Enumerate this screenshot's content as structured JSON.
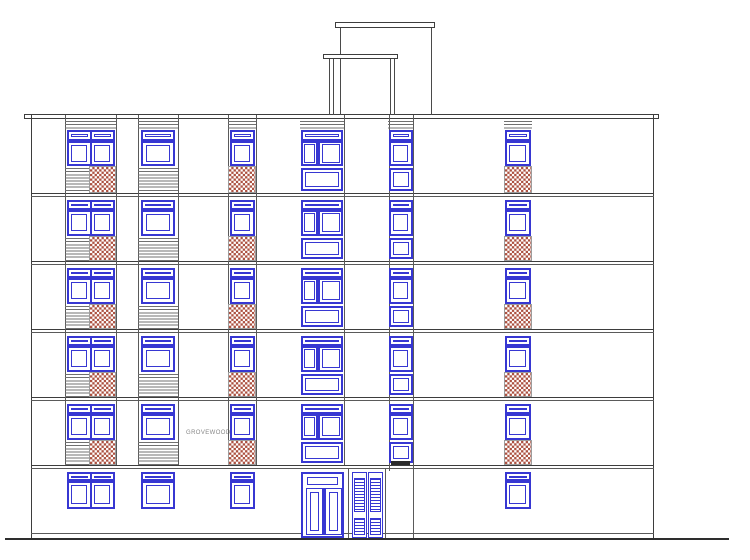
{
  "label": {
    "text": "GROVEWOOD",
    "x": 186,
    "y": 430
  },
  "canvas": {
    "width": 750,
    "height": 560
  },
  "colors": {
    "background": "#ffffff",
    "window_blue": "#3737d2",
    "brick_red": "#ac5140",
    "outline_dark": "#3d3d3d",
    "line_gray": "#5a5a5a",
    "stripe_gray": "#707070",
    "brick_border": "#9d9d9d",
    "vent_dark": "#2b2b2b",
    "ground_dark": "#2e2e2e"
  },
  "building": {
    "left": 31,
    "right": 654,
    "top": 115,
    "bottom": 537.5
  },
  "roof_band": {
    "x1": 24,
    "x2": 659,
    "y_top": 114,
    "y_bottom": 117.5
  },
  "floor_line_ys": [
    193,
    261,
    329,
    397,
    465
  ],
  "plinth_line": {
    "y": 532.5,
    "x1": 31,
    "x2": 654
  },
  "ground_line": {
    "y": 537.5,
    "x1": 5,
    "x2": 729,
    "thickness": 2.5
  },
  "penthouse": {
    "back": {
      "cap_x": 334.5,
      "cap_y": 22,
      "cap_w": 100,
      "cap_h": 5.5,
      "verticals": [
        339.5,
        430.5
      ],
      "v_y1": 27.5,
      "v_y2": 115
    },
    "front": {
      "cap_x": 322.5,
      "cap_y": 54,
      "cap_w": 75,
      "cap_h": 5,
      "verticals": [
        329,
        332.5,
        390,
        394
      ],
      "v_y1": 59,
      "v_y2": 115
    }
  },
  "joints": {
    "facade": [
      64.5,
      115.5,
      138,
      177.5,
      227.5,
      256,
      343.5
    ],
    "facade_y1": 115,
    "facade_y2": 465,
    "extended": [
      {
        "x": 388.5,
        "y1": 115,
        "y2": 471
      },
      {
        "x": 412.5,
        "y1": 115,
        "y2": 537.5
      },
      {
        "x": 348,
        "y1": 468,
        "y2": 537.5
      },
      {
        "x": 384.5,
        "y1": 468,
        "y2": 537.5
      }
    ]
  },
  "rows": {
    "top": {
      "band_y": 118.5,
      "band_h": 10.5,
      "transom_y": 130,
      "transom_h": 10.5,
      "win_y": 140.5,
      "win_h": 25.5,
      "low_y": 166,
      "low_h": 26.5
    },
    "middle_template": {
      "transom_dy": 6.5,
      "transom_h": 10,
      "win_dy": 16.5,
      "win_h": 26,
      "low_dy": 42.5,
      "low_h": 25.5
    },
    "middle_tops": [
      193,
      261,
      329,
      397
    ],
    "ground": {
      "transom_y": 471.5,
      "transom_h": 9,
      "win_y": 480.5,
      "win_h": 28
    }
  },
  "bays": [
    {
      "id": "bay-1",
      "panel_x": 64.5,
      "panel_w": 51,
      "win_x": 66.5,
      "win_w": 48,
      "split": 23,
      "style": "double",
      "low": "stripes-brick",
      "stripe_w": 24.5,
      "brick_x": 89,
      "brick_w": 26.5,
      "top_band": "stripes",
      "ground": "double-window"
    },
    {
      "id": "bay-2",
      "panel_x": 138,
      "panel_w": 39.5,
      "win_x": 141,
      "win_w": 33.5,
      "style": "single",
      "low": "stripes",
      "top_band": "stripes",
      "ground": "window"
    },
    {
      "id": "bay-3",
      "panel_x": 227.5,
      "panel_w": 28.5,
      "win_x": 229.5,
      "win_w": 25,
      "style": "single",
      "low": "brick",
      "top_band": "lintel",
      "ground": "window"
    },
    {
      "id": "bay-4",
      "panel_x": 299.5,
      "panel_w": 44,
      "win_x": 300.5,
      "win_w": 42.5,
      "style": "divided",
      "low": "panel",
      "top_band": "lintel",
      "ground": "door"
    },
    {
      "id": "bay-5",
      "panel_x": 388,
      "panel_w": 25,
      "win_x": 388.5,
      "win_w": 24,
      "style": "single",
      "low": "panel",
      "top_band": "lintel",
      "ground": "none"
    },
    {
      "id": "bay-6",
      "panel_x": 503.5,
      "panel_w": 28,
      "win_x": 504.5,
      "win_w": 26,
      "style": "single",
      "low": "brick",
      "top_band": "lintel",
      "ground": "window"
    }
  ],
  "vent_grille": {
    "x": 390.5,
    "y": 460.5,
    "w": 19,
    "h": 4.5
  },
  "entrance_door": {
    "x": 300.5,
    "y": 471.5,
    "w": 43,
    "h": 66.5
  },
  "louvre_door": {
    "x": 351.5,
    "y": 471.5,
    "panel_w": 15.5,
    "gap": 0.5,
    "h": 66,
    "upper": {
      "dy": 5,
      "h": 34
    },
    "lower": {
      "dy": 45,
      "h": 17
    }
  }
}
